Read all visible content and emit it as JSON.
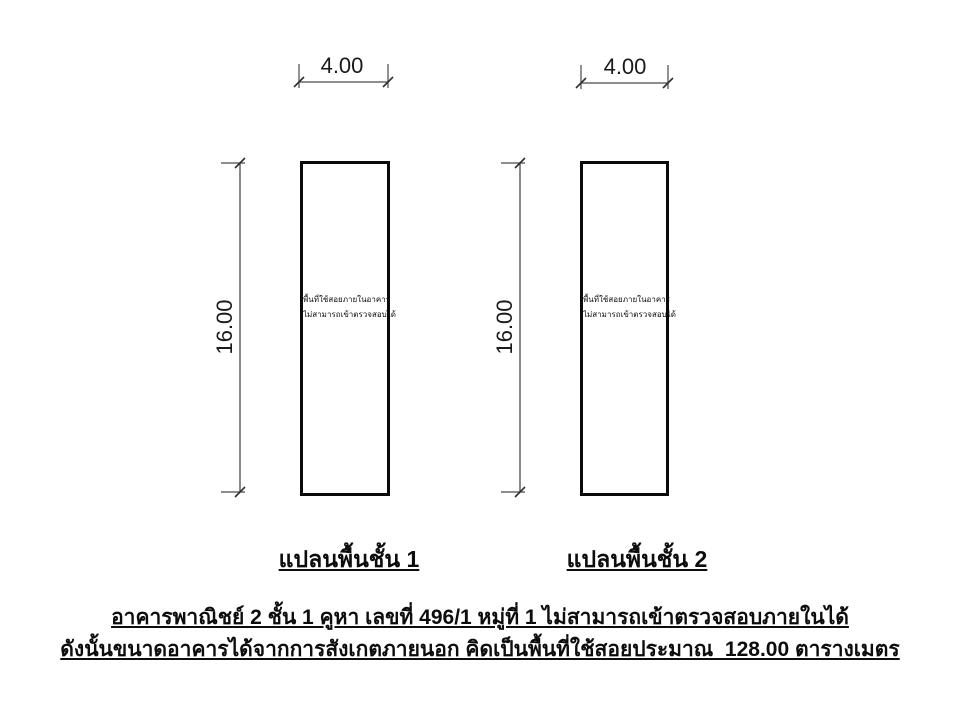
{
  "page": {
    "background_color": "#ffffff",
    "dimension_line_color": "#4a4a4a",
    "wall_line_color": "#0a0a0a",
    "text_color": "#111111"
  },
  "plans": [
    {
      "width_dim": "4.00",
      "height_dim": "16.00",
      "interior_note_line1": "พื้นที่ใช้สอยภายในอาคาร",
      "interior_note_line2": "ไม่สามารถเข้าตรวจสอบได้",
      "caption": "แปลนพื้นชั้น 1"
    },
    {
      "width_dim": "4.00",
      "height_dim": "16.00",
      "interior_note_line1": "พื้นที่ใช้สอยภายในอาคาร",
      "interior_note_line2": "ไม่สามารถเข้าตรวจสอบได้",
      "caption": "แปลนพื้นชั้น 2"
    }
  ],
  "notes": {
    "line1": "อาคารพาณิชย์ 2 ชั้น 1 คูหา เลขที่ 496/1 หมู่ที่ 1 ไม่สามารถเข้าตรวจสอบภายในได้",
    "line2": "ดังนั้นขนาดอาคารได้จากการสังเกตภายนอก คิดเป็นพื้นที่ใช้สอยประมาณ  128.00 ตารางเมตร"
  }
}
